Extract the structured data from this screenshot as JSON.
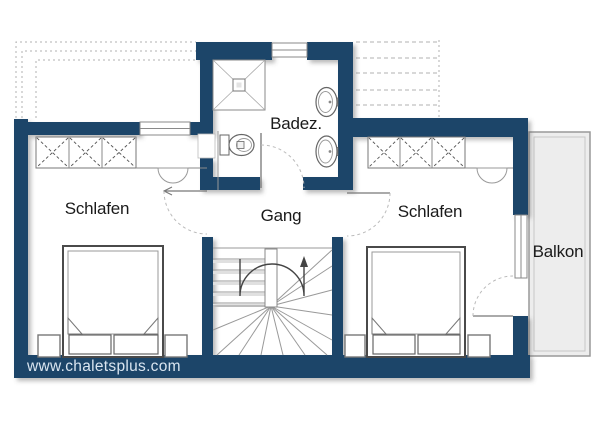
{
  "plan": {
    "labels": {
      "bathroom": "Badez.",
      "hallway": "Gang",
      "bedroom_left": "Schlafen",
      "bedroom_right": "Schlafen",
      "balcony": "Balkon"
    },
    "watermark": "www.chaletsplus.com",
    "colors": {
      "wall": "#1e4569",
      "balcony_fill": "#ededed",
      "line": "#8a8a8a",
      "label_text": "#1a1a1a",
      "watermark_text": "#d9e5f0"
    },
    "fixtures": [
      "shower",
      "toilet",
      "washbasin",
      "washbasin",
      "wardrobe",
      "wardrobe",
      "double-bed",
      "double-bed",
      "winder-staircase",
      "balcony"
    ]
  }
}
